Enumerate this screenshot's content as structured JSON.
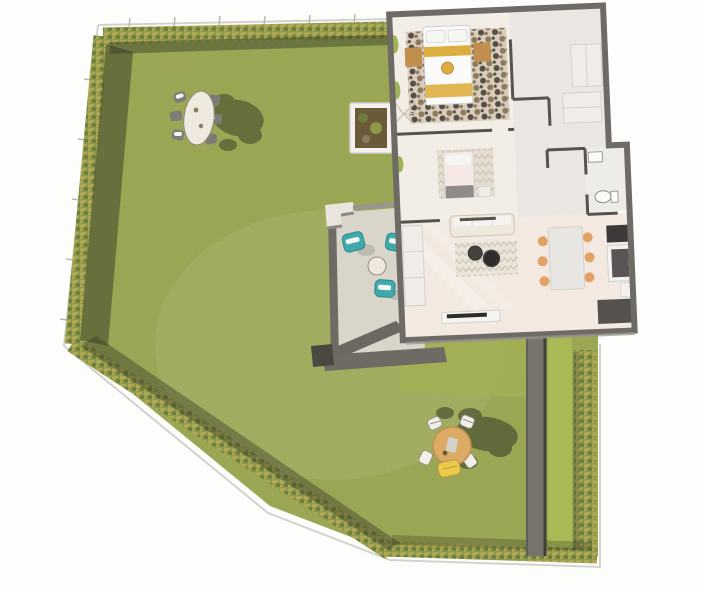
{
  "meta": {
    "title": "3D top-down rendering of a single-storey house floor plan with garden",
    "view": "aerial 3D render, roof removed",
    "visible_text": "none"
  },
  "colors": {
    "background": "#fdfdfc",
    "lawn": "#9aa654",
    "lawn_bright": "#a9ba55",
    "lawn_soft": "#a3b052",
    "hedge_base": "#8f974b",
    "hedge_light": "#b5a756",
    "hedge_dark": "#6f7c3c",
    "hedge_pale": "#a5ad52",
    "shadow_olive": "#343a26",
    "fence": "#d2d2cd",
    "fence_post": "#b9b9b4",
    "path_wall": "#76746c",
    "path_wall_dark": "#3f3e39",
    "wall_outer": "#6e6a65",
    "wall_inner": "#57534f",
    "wall_light": "#9a948d",
    "house_floor": "#f2ede5",
    "house_floor_warm": "#f3e9e0",
    "hall_floor": "#eae7e2",
    "bath_floor": "#edece8",
    "terrace_gravel": "#d9d5cb",
    "terrace_wall": "#6e6a64",
    "terrace_wall_dark": "#4b4842",
    "corner_block": "#ece5df",
    "corner_block_side": "#8f8a83",
    "rug_hide_base": "#d9cdbc",
    "rug_hide_dark": "#574f45",
    "rug_hide_brown": "#8c7a5f",
    "chevron_bg": "#eae4d9",
    "chevron_line": "#cfc6b8",
    "zigzag_bg": "#e6ddd2",
    "zigzag_line": "#cbbfae",
    "bed_white": "#fafafa",
    "bed_yellow": "#dcae3f",
    "bed_pink": "#f6e8e4",
    "blanket_gray": "#8e8b88",
    "wood": "#c08f4e",
    "sofa": "#efe8dc",
    "cupboard": "#f0ede8",
    "tv_unit": "#f6f4f1",
    "tv_screen": "#2e2c2a",
    "coffee_table": "#46423e",
    "dining_table": "#e8e6e2",
    "chair_orange": "#e2a266",
    "counter_dark": "#55524e",
    "appliance_glass": "#3c3a38",
    "fridge_white": "#f4f2ee",
    "toilet_white": "#fbfbfa",
    "teal_chair": "#3fa9ab",
    "teal_chair_dark": "#2c8a8d",
    "towel_white": "#f4f6f4",
    "side_table": "#efe9df",
    "garden_table_tan": "#dcab66",
    "garden_table_edge": "#c2914e",
    "chair_white": "#f2efe9",
    "chair_gray": "#7d7d77",
    "lounge_yellow": "#e9cb45",
    "plant_green": "#9fb457",
    "planter_white": "#f5f2ee",
    "planter_soil": "#6b5a3a",
    "sun_beam": "#ffffff"
  },
  "garden": {
    "lawn_shape": "irregular polygon bordered by hedges and a thin fence",
    "hedges": [
      "top",
      "left",
      "diagonal-bottom-left",
      "bottom",
      "right-strip"
    ],
    "walkway": "dark vertical wall strip on lower right",
    "furniture": {
      "oval_dining_set": {
        "table": "oval white table",
        "chairs": 6
      },
      "round_table_set": {
        "table": "round tan table",
        "chairs": 4,
        "lounge_chairs": 1
      }
    }
  },
  "terrace": {
    "surface": "light gravel with low dark walls",
    "lounge_chairs": 3,
    "side_tables": 1,
    "planter_boxes": 1
  },
  "house": {
    "rooms": [
      "master-bedroom",
      "second-bedroom",
      "hallway",
      "bathroom",
      "living-room",
      "kitchen-dining"
    ],
    "furniture": {
      "master_bedroom": [
        "double-bed",
        "nightstand-left",
        "nightstand-right",
        "cowhide-rug",
        "plant"
      ],
      "second_bedroom": [
        "single-bed",
        "zigzag-rug",
        "nightstand"
      ],
      "living_room": [
        "sofa",
        "chevron-rug",
        "coffee-table",
        "coffee-table",
        "tv-unit",
        "cupboard"
      ],
      "dining": [
        "dining-table",
        "chairs-x6"
      ],
      "kitchen": [
        "cooktop-counter",
        "fridge",
        "lower-counter"
      ],
      "bathroom": [
        "toilet",
        "washbasin"
      ],
      "hallway": [
        "wardrobe",
        "wardrobe"
      ]
    }
  }
}
